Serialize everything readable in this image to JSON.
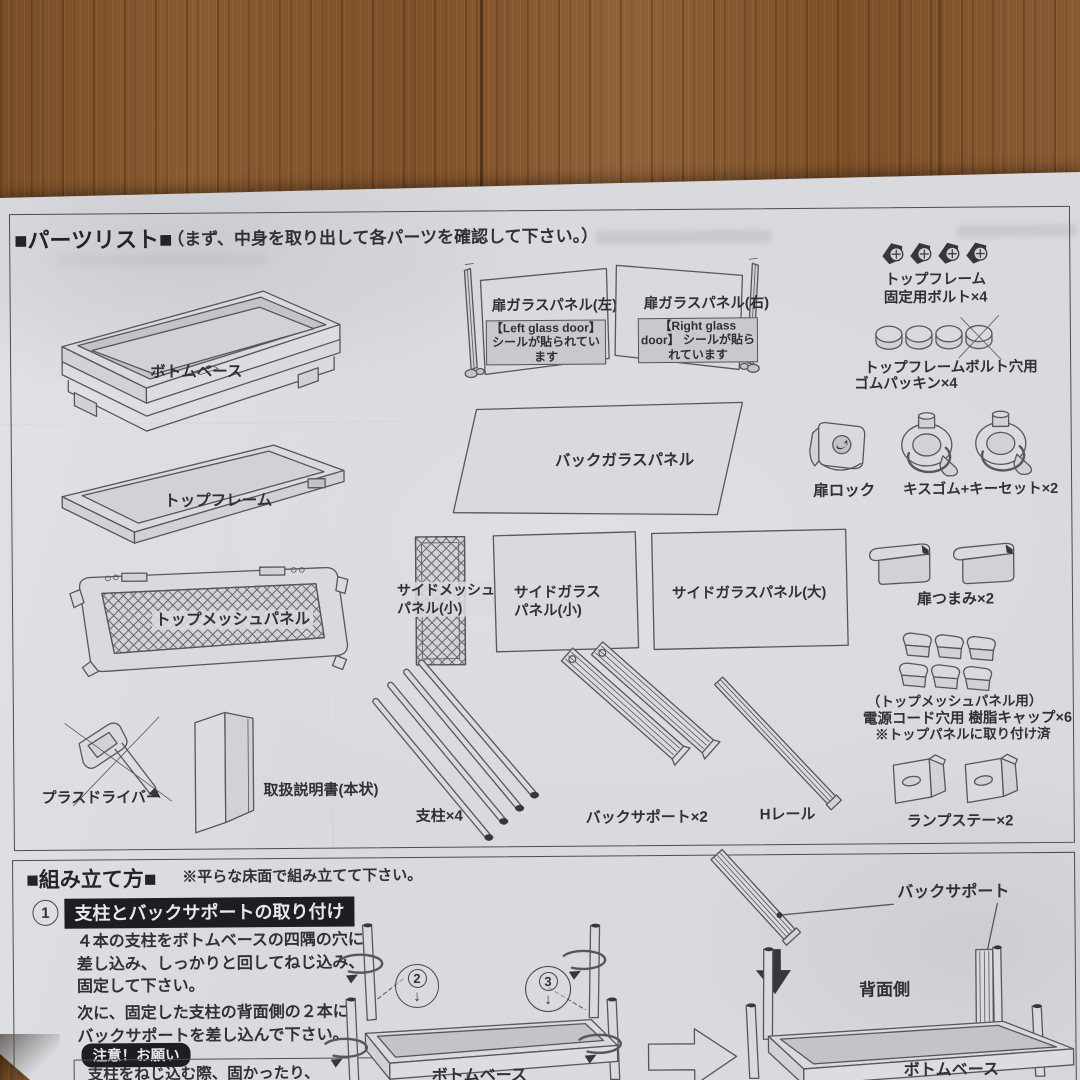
{
  "parts": {
    "header": "■パーツリスト■",
    "subtitle": "（まず、中身を取り出して各パーツを確認して下さい。）",
    "bottom_base": "ボトムベース",
    "top_frame": "トップフレーム",
    "top_mesh": "トップメッシュパネル",
    "door_left": "扉ガラスパネル(左)",
    "door_left_sticker": "【Left glass door】\nシールが貼られています",
    "door_right": "扉ガラスパネル(右)",
    "door_right_sticker": "【Right glass door】\nシールが貼られています",
    "back_glass": "バックガラスパネル",
    "side_mesh": "サイドメッシュ\nパネル(小)",
    "side_glass_small": "サイドガラス\nパネル(小)",
    "side_glass_large": "サイドガラスパネル(大)",
    "screwdriver": "プラスドライバー",
    "manual": "取扱説明書(本状)",
    "posts": "支柱×4",
    "back_support": "バックサポート×2",
    "h_rail": "Hレール",
    "bolts": "トップフレーム\n固定用ボルト×4",
    "packing_1": "トップフレームボルト穴用",
    "packing_2": "ゴムパッキン×4",
    "door_lock": "扉ロック",
    "suction": "キスゴム+キーセット×2",
    "knob": "扉つまみ×2",
    "caps_1": "（トップメッシュパネル用）",
    "caps_2": "電源コード穴用 樹脂キャップ×6",
    "caps_3": "※トップパネルに取り付け済",
    "lamp_stay": "ランプステー×2"
  },
  "assembly": {
    "header": "■組み立て方■",
    "note": "※平らな床面で組み立てて下さい。",
    "step_no": "1",
    "step_title": "支柱とバックサポートの取り付け",
    "para1": "４本の支柱をボトムベースの四隅の穴に\n差し込み、しっかりと回してねじ込み、\n固定して下さい。",
    "para2": "次に、固定した支柱の背面側の２本に\nバックサポートを差し込んで下さい。",
    "caution_title": "注意！お願い",
    "caution_line": "支柱をねじ込む際、固かったり、",
    "callout2": "2",
    "callout3": "3",
    "down_arrow": "↓",
    "label_back_support": "バックサポート",
    "label_rear_side": "背面側",
    "label_bottom_base1": "ボトムベース",
    "label_bottom_base2": "ボトムベース"
  }
}
